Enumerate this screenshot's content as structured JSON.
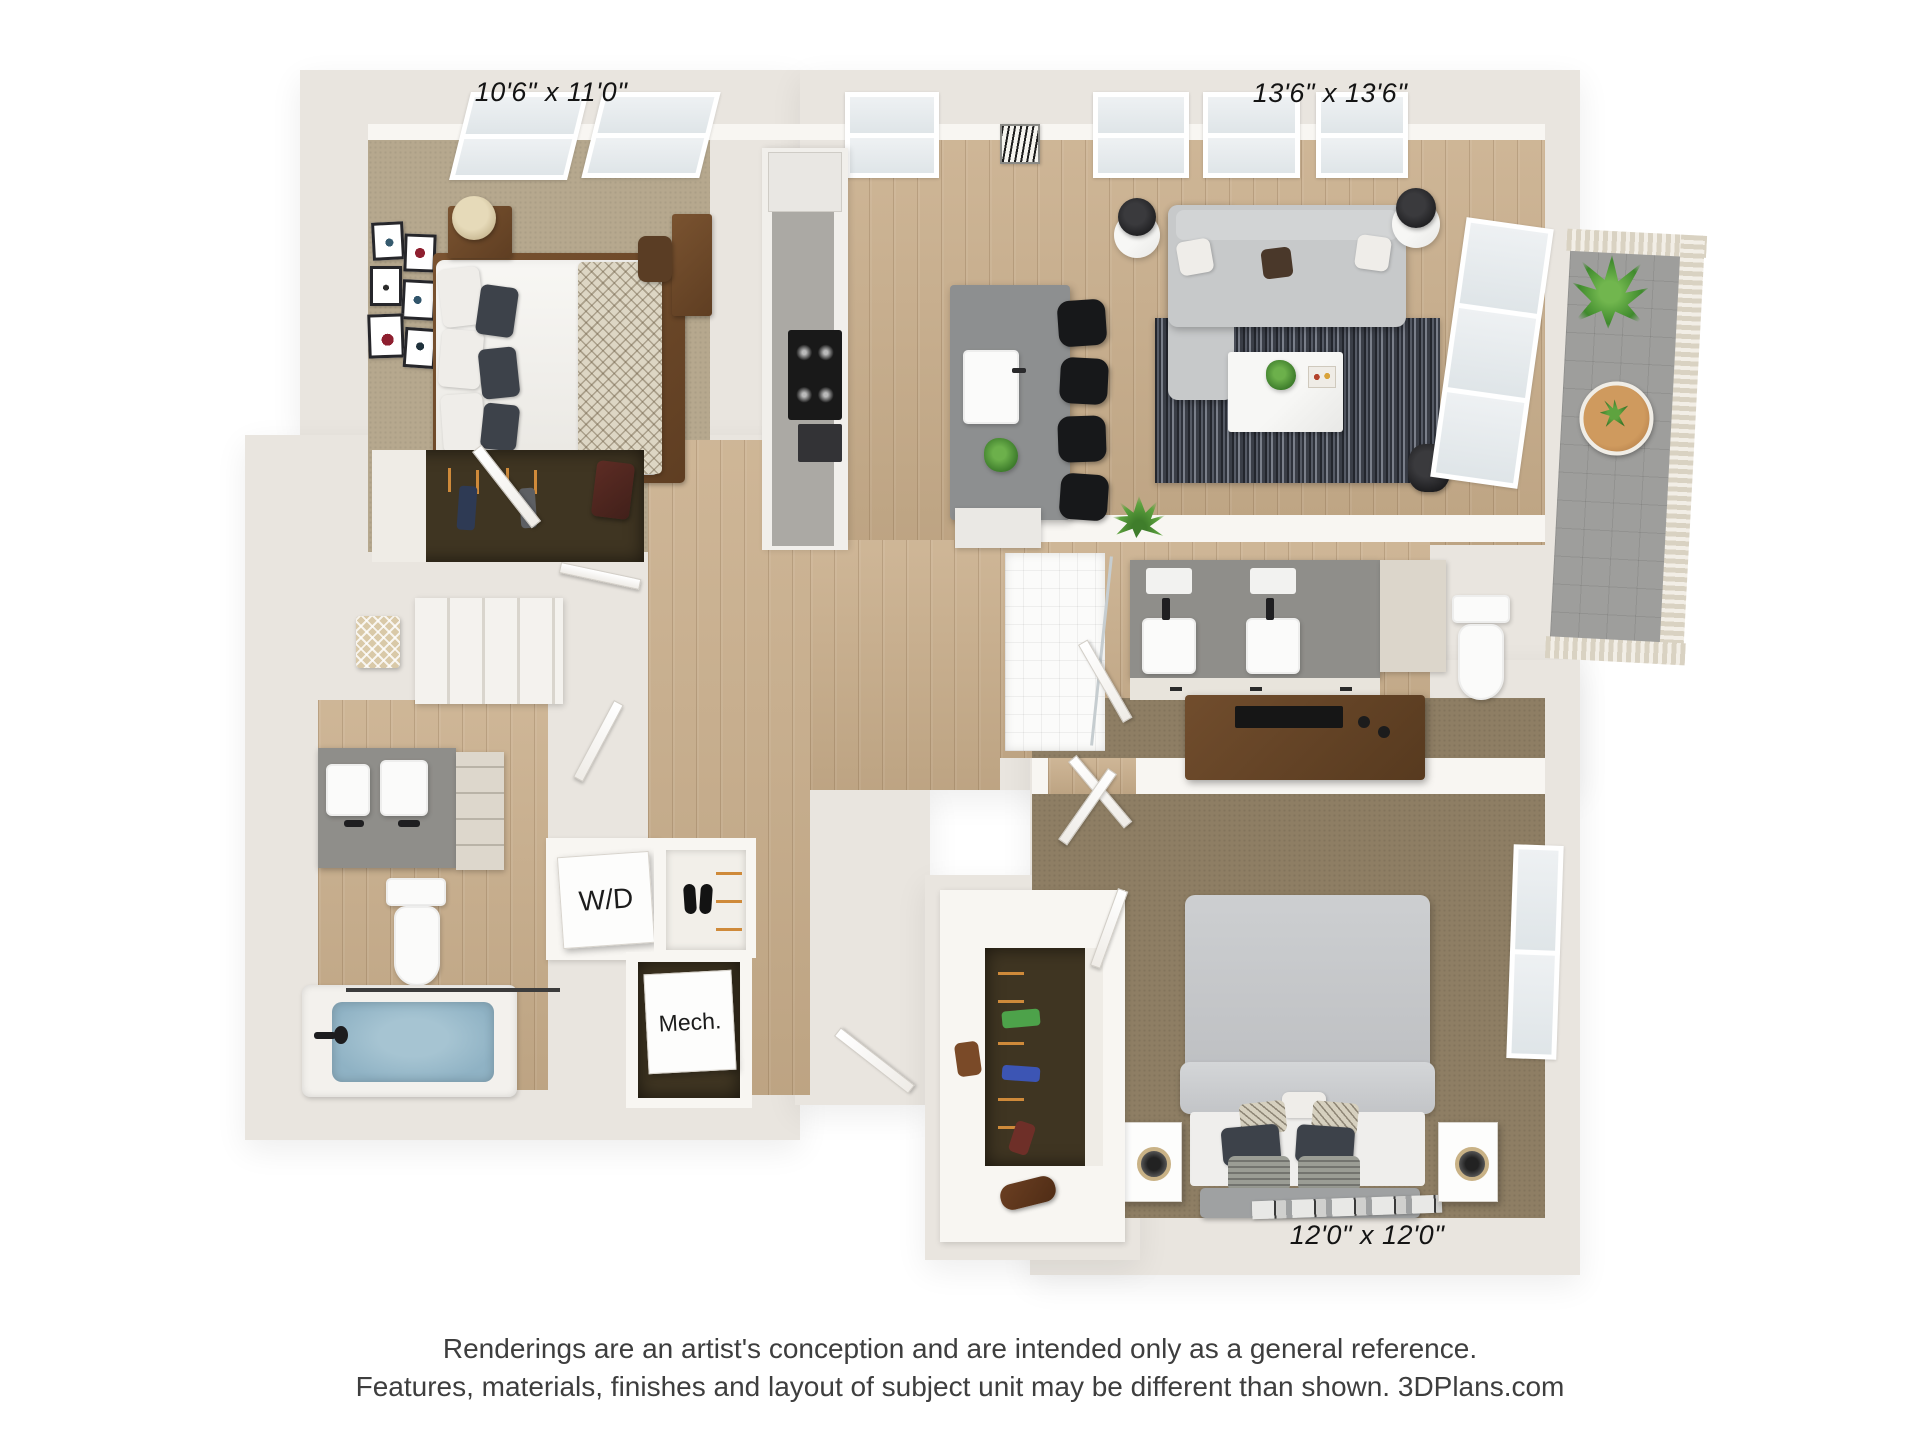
{
  "plan": {
    "dimension_labels": {
      "bedroom_1": "10'6\" x 11'0\"",
      "living_room": "13'6\" x 13'6\"",
      "bedroom_2": "12'0\" x 12'0\""
    },
    "closet_labels": {
      "washer_dryer": "W/D",
      "mechanical": "Mech."
    }
  },
  "footer": {
    "line1": "Renderings are an artist's conception and are intended only as a general reference.",
    "line2": "Features, materials, finishes and layout of subject unit may be different than shown. 3DPlans.com"
  },
  "colors": {
    "background": "#ffffff",
    "outer_wall": "#e9e5df",
    "inner_wall": "#f8f6f2",
    "wood_floor": "#c9ae8b",
    "carpet_bedroom_1": "#b6a88e",
    "carpet_bedroom_2": "#8e7e64",
    "rug_dark": "#2e323b",
    "tub_water": "#8fb2c4",
    "plant_green": "#4f9a3c",
    "label_text": "#141414"
  }
}
